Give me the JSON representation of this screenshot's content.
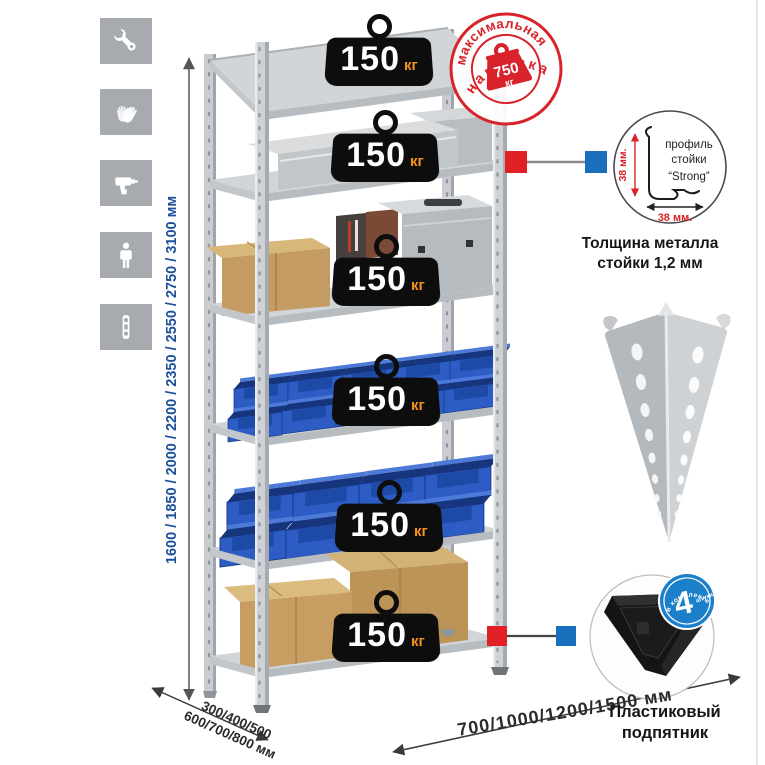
{
  "sidebar": {
    "icons": [
      {
        "name": "wrench"
      },
      {
        "name": "gloves"
      },
      {
        "name": "drill"
      },
      {
        "name": "person"
      },
      {
        "name": "level"
      }
    ]
  },
  "rack": {
    "shelves": [
      {
        "capacity": "150",
        "unit": "кг"
      },
      {
        "capacity": "150",
        "unit": "кг"
      },
      {
        "capacity": "150",
        "unit": "кг"
      },
      {
        "capacity": "150",
        "unit": "кг"
      },
      {
        "capacity": "150",
        "unit": "кг"
      },
      {
        "capacity": "150",
        "unit": "кг"
      }
    ]
  },
  "max_load_stamp": {
    "arc_top": "максимальная",
    "arc_bottom": "нагрузка",
    "value": "750",
    "unit": "кг"
  },
  "dimensions": {
    "height": "1600 / 1850 / 2000 / 2200 / 2350 / 2550 / 2750 / 3100 мм",
    "depth_line1": "300/400/500",
    "depth_line2": "600/700/800 мм",
    "width": "700/1000/1200/1500 мм"
  },
  "profile_detail": {
    "label_line1": "профиль",
    "label_line2": "стойки",
    "label_line3": "“Strong”",
    "dim_vertical": "38 мм.",
    "dim_horizontal": "38 мм.",
    "caption_line1": "Толщина металла",
    "caption_line2": "стойки 1,2 мм"
  },
  "foot_detail": {
    "badge_value": "4",
    "badge_note": "штуки",
    "badge_arc": "в комплекте",
    "caption_line1": "Пластиковый",
    "caption_line2": "подпятник"
  },
  "colors": {
    "stamp_red": "#d8232a",
    "badge_blue": "#1b7fca",
    "dimension_blue": "#1d4f9c",
    "weight_unit_orange": "#f7941e",
    "bin_blue": "#2c5cc4",
    "marker_red": "#e02025",
    "marker_blue": "#1a6fbd",
    "metal_gray": "#ced2d6"
  }
}
